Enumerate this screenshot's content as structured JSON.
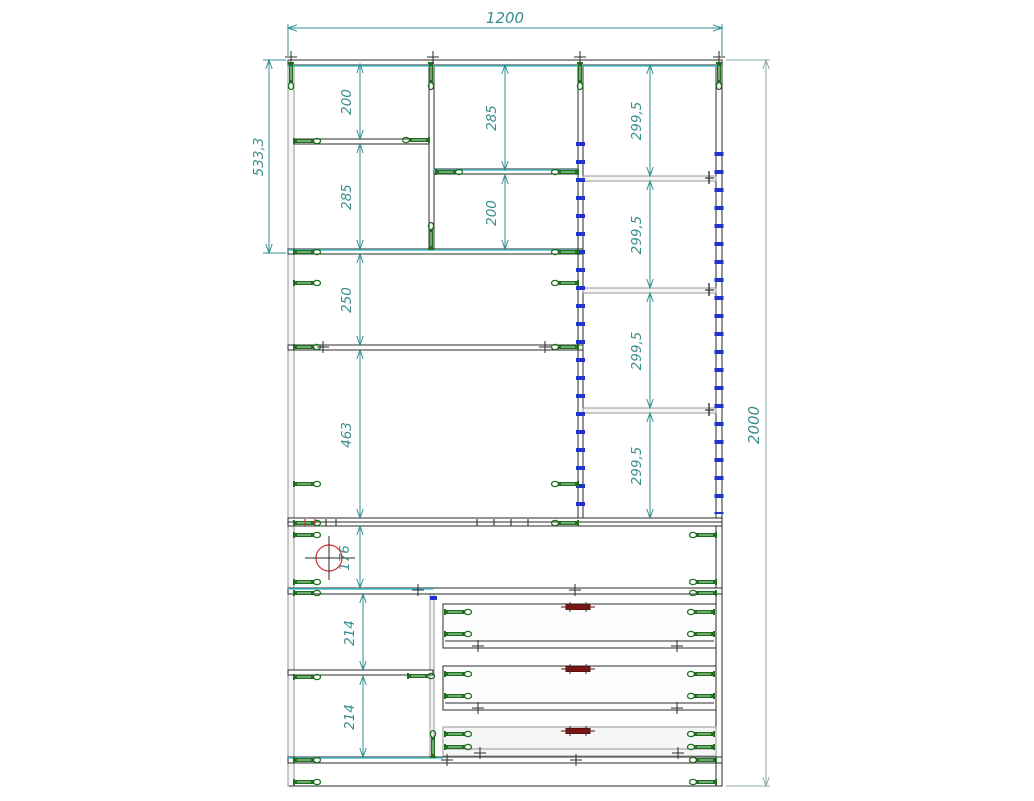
{
  "drawing": {
    "type": "furniture-assembly-cad-drawing",
    "subject": "wardrobe cabinet front view with fastener symbols",
    "dims": {
      "overall": {
        "width": "1200",
        "height": "2000"
      },
      "left_block_height": "533,3",
      "column1": {
        "upper": "200",
        "lower": "285"
      },
      "column2": {
        "upper": "285",
        "lower": "200"
      },
      "column3": {
        "sections": [
          "299,5",
          "299,5",
          "299,5",
          "299,5"
        ]
      },
      "middle": {
        "shelf_section": "250",
        "tall_section": "463",
        "hanger_section": "176"
      },
      "drawer_column": {
        "sections": [
          "214",
          "214"
        ]
      }
    },
    "colors": {
      "dimension_teal": "#2f8f8f",
      "dimension_gray": "#8fa8ad",
      "structure_dark": "#2b2b2b",
      "structure_gray": "#949494",
      "selection_cyan": "#4fc3d0",
      "confirmat_green": "#1f6f1f",
      "shelf_pin_blue": "#2233cc",
      "handle_red": "#7d1515",
      "grommet_red": "#cc3333",
      "background": "#ffffff"
    },
    "symbols": {
      "confirmat_screw": "green elongated screw glyph",
      "shelf_pin_holes": "blue tick marks along panels",
      "drawer_handle": "dark red bar with two screws",
      "grommet": "red circle with crosshair",
      "cross_fastener": "small plus mark"
    }
  }
}
